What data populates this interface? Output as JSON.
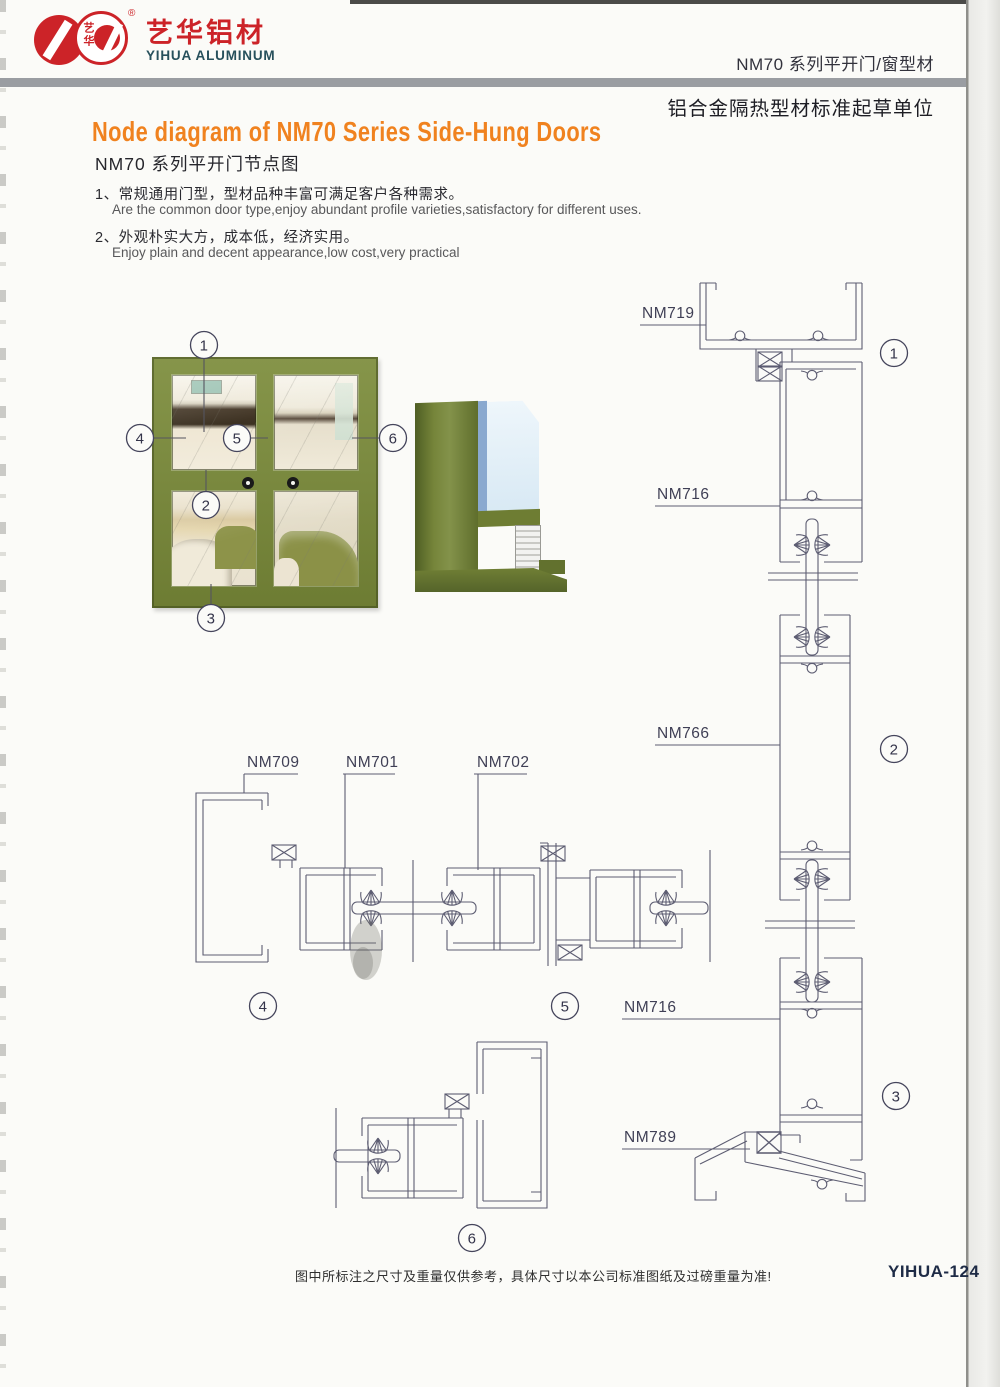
{
  "header": {
    "brand_cn": "艺华铝材",
    "brand_en": "YIHUA ALUMINUM",
    "reg_mark": "®",
    "seal": "艺华",
    "series_line": "NM70 系列平开门/窗型材",
    "cert_line": "铝合金隔热型材标准起草单位"
  },
  "title": {
    "en": "Node diagram of NM70 Series Side-Hung Doors",
    "cn": "NM70 系列平开门节点图"
  },
  "features": {
    "f1": {
      "cn": "1、常规通用门型，型材品种丰富可满足客户各种需求。",
      "en": "Are the common door type,enjoy abundant profile varieties,satisfactory for different uses."
    },
    "f2": {
      "cn": "2、外观朴实大方，成本低，经济实用。",
      "en": "Enjoy plain and decent appearance,low cost,very practical"
    }
  },
  "photo": {
    "callouts": {
      "c1": "1",
      "c2": "2",
      "c3": "3",
      "c4": "4",
      "c5": "5",
      "c6": "6"
    }
  },
  "diagrams": {
    "labels": {
      "head_frame": "NM719",
      "stile_upper": "NM716",
      "mullion": "NM766",
      "stile_lower": "NM716",
      "sill": "NM789",
      "jamb": "NM709",
      "stile": "NM701",
      "lock_stile": "NM702"
    },
    "sections": {
      "s1": "1",
      "s2": "2",
      "s3": "3",
      "s4": "4",
      "s5": "5",
      "s6": "6"
    }
  },
  "footer": {
    "disclaimer": "图中所标注之尺寸及重量仅供参考，具体尺寸以本公司标准图纸及过磅重量为准!",
    "page_no": "YIHUA-124"
  },
  "colors": {
    "accent_orange": "#f0821f",
    "logo_red": "#cc2328",
    "logo_navy": "#27505c",
    "line": "#5d5d72",
    "bar_gray": "#9a9da2",
    "door_green": "#7d8c42"
  }
}
